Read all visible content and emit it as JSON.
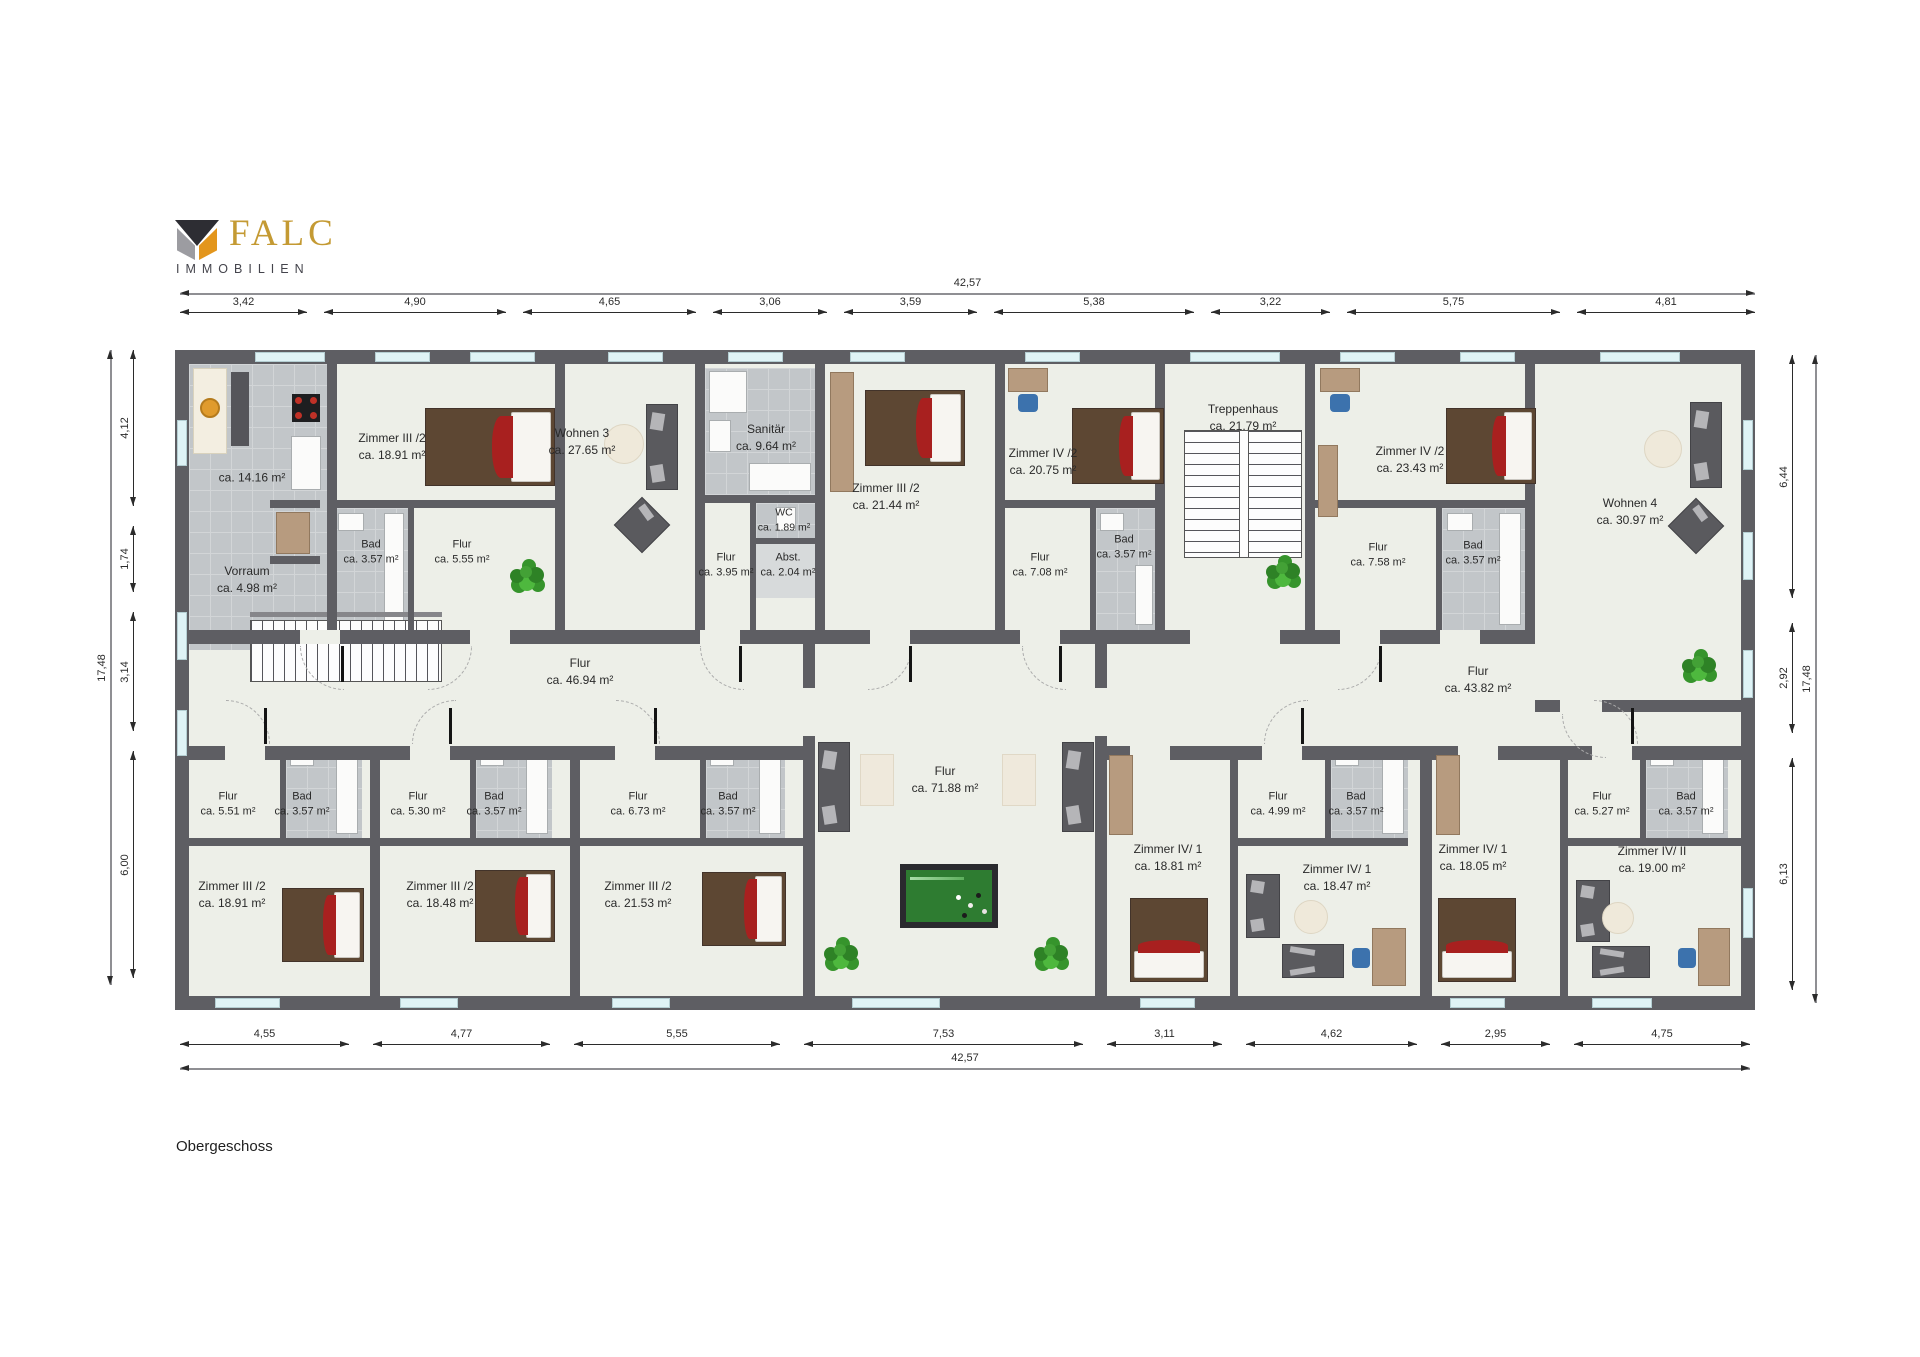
{
  "logo": {
    "brand": "FALC",
    "subtitle": "IMMOBILIEN"
  },
  "floor_label": "Obergeschoss",
  "palette": {
    "brand_gold": "#C49A33",
    "wall_gray": "#5E5E63",
    "window_cyan": "#DFF3F6",
    "bed_red": "#A8201F"
  },
  "dimensions": {
    "top_total": "42,57",
    "bottom_total": "42,57",
    "left_total": "17,48",
    "right_total": "17,48",
    "top": [
      "3,42",
      "4,90",
      "4,65",
      "3,06",
      "3,59",
      "5,38",
      "3,22",
      "5,75",
      "4,81"
    ],
    "bottom": [
      "4,55",
      "4,77",
      "5,55",
      "7,53",
      "3,11",
      "4,62",
      "2,95",
      "4,75"
    ],
    "left": [
      "4,12",
      "1,74",
      "3,14",
      "6,00"
    ],
    "right": [
      "6,44",
      "2,92",
      "6,13"
    ]
  },
  "rooms": {
    "ausgabekueche": {
      "name": "Ausgabeküche",
      "area": "ca. 14.16 m²"
    },
    "vorraum": {
      "name": "Vorraum",
      "area": "ca. 4.98 m²"
    },
    "zimmer3_2_a": {
      "name": "Zimmer III /2",
      "area": "ca. 18.91 m²"
    },
    "bad_a": {
      "name": "Bad",
      "area": "ca. 3.57 m²"
    },
    "flur_a": {
      "name": "Flur",
      "area": "ca. 5.55 m²"
    },
    "wohnen3": {
      "name": "Wohnen 3",
      "area": "ca. 27.65 m²"
    },
    "sanitaer": {
      "name": "Sanitär",
      "area": "ca. 9.64 m²"
    },
    "wc": {
      "name": "WC",
      "area": "ca. 1.89 m²"
    },
    "flur_b": {
      "name": "Flur",
      "area": "ca. 3.95 m²"
    },
    "abst": {
      "name": "Abst.",
      "area": "ca. 2.04 m²"
    },
    "zimmer3_2_b": {
      "name": "Zimmer III /2",
      "area": "ca. 21.44 m²"
    },
    "zimmer4_2_a": {
      "name": "Zimmer IV /2",
      "area": "ca. 20.75 m²"
    },
    "flur_c": {
      "name": "Flur",
      "area": "ca. 7.08 m²"
    },
    "bad_b": {
      "name": "Bad",
      "area": "ca. 3.57 m²"
    },
    "treppenhaus": {
      "name": "Treppenhaus",
      "area": "ca. 21.79 m²"
    },
    "zimmer4_2_b": {
      "name": "Zimmer IV /2",
      "area": "ca. 23.43 m²"
    },
    "flur_d": {
      "name": "Flur",
      "area": "ca. 7.58 m²"
    },
    "bad_c": {
      "name": "Bad",
      "area": "ca. 3.57 m²"
    },
    "wohnen4": {
      "name": "Wohnen 4",
      "area": "ca. 30.97 m²"
    },
    "flur_left": {
      "name": "Flur",
      "area": "ca. 46.94 m²"
    },
    "flur_center": {
      "name": "Flur",
      "area": "ca. 71.88 m²"
    },
    "flur_right": {
      "name": "Flur",
      "area": "ca. 43.82 m²"
    },
    "flur_1": {
      "name": "Flur",
      "area": "ca. 5.51 m²"
    },
    "bad_1": {
      "name": "Bad",
      "area": "ca. 3.57 m²"
    },
    "zimmer3_2_c": {
      "name": "Zimmer III /2",
      "area": "ca. 18.91 m²"
    },
    "flur_2": {
      "name": "Flur",
      "area": "ca. 5.30 m²"
    },
    "bad_2": {
      "name": "Bad",
      "area": "ca. 3.57 m²"
    },
    "zimmer3_2_d": {
      "name": "Zimmer III /2",
      "area": "ca. 18.48 m²"
    },
    "flur_3": {
      "name": "Flur",
      "area": "ca. 6.73 m²"
    },
    "bad_3": {
      "name": "Bad",
      "area": "ca. 3.57 m²"
    },
    "zimmer3_2_e": {
      "name": "Zimmer III /2",
      "area": "ca. 21.53 m²"
    },
    "zimmer4_1_a": {
      "name": "Zimmer IV/ 1",
      "area": "ca. 18.81 m²"
    },
    "flur_4": {
      "name": "Flur",
      "area": "ca. 4.99 m²"
    },
    "bad_4": {
      "name": "Bad",
      "area": "ca. 3.57 m²"
    },
    "zimmer4_1_b": {
      "name": "Zimmer IV/ 1",
      "area": "ca. 18.47 m²"
    },
    "zimmer4_1_c": {
      "name": "Zimmer IV/ 1",
      "area": "ca. 18.05 m²"
    },
    "flur_5": {
      "name": "Flur",
      "area": "ca. 5.27 m²"
    },
    "bad_5": {
      "name": "Bad",
      "area": "ca. 3.57 m²"
    },
    "zimmer4_2_ii": {
      "name": "Zimmer IV/ II",
      "area": "ca. 19.00 m²"
    }
  }
}
